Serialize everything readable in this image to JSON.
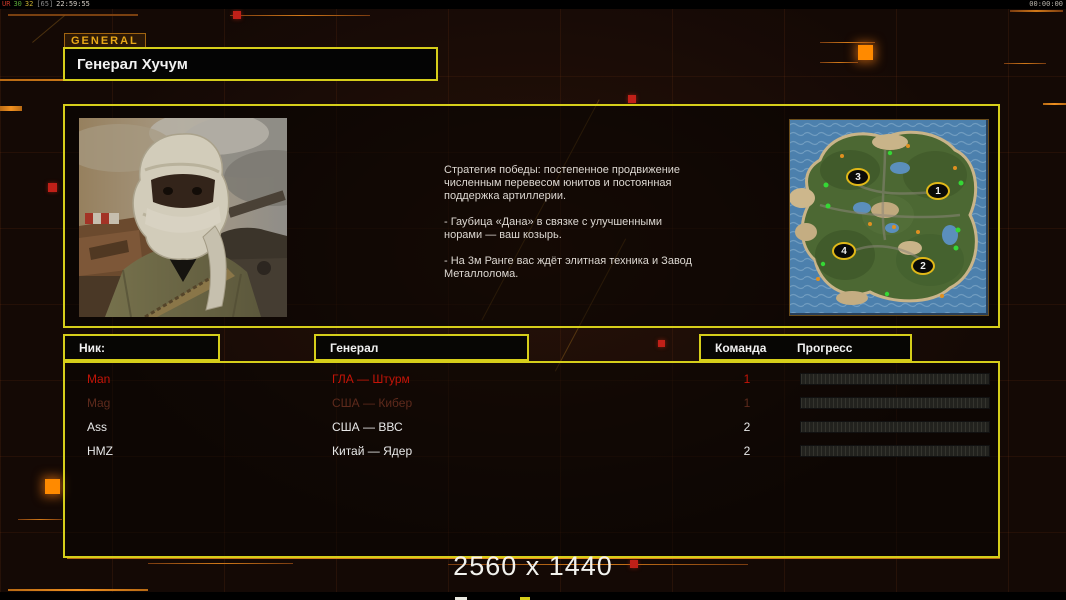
{
  "topbar": {
    "debug": {
      "p1": "UR",
      "p2": "30",
      "p3": "32",
      "p4": "[65]",
      "time": "22:59:55"
    },
    "timer": "00:00:00"
  },
  "header": {
    "tab_label": "GENERAL",
    "title": "Генерал Хучум"
  },
  "briefing": {
    "paragraphs": [
      "Стратегия победы: постепенное продвижение численным перевесом юнитов и постоянная поддержка артиллерии.",
      "- Гаубица «Дана» в связке с улучшенными норами — ваш козырь.",
      "- На 3м Ранге вас ждёт элитная техника и Завод Металлолома."
    ]
  },
  "minimap": {
    "markers": [
      {
        "label": "1"
      },
      {
        "label": "2"
      },
      {
        "label": "3"
      },
      {
        "label": "4"
      }
    ]
  },
  "table": {
    "headers": {
      "nick": "Ник:",
      "general": "Генерал",
      "team": "Команда",
      "progress": "Прогресс"
    },
    "rows": [
      {
        "nick": "Man",
        "general": "ГЛА — Штурм",
        "team": "1",
        "state": "red"
      },
      {
        "nick": "Mag",
        "general": "США — Кибер",
        "team": "1",
        "state": "dim"
      },
      {
        "nick": "Ass",
        "general": "США — ВВС",
        "team": "2",
        "state": "normal"
      },
      {
        "nick": "HMZ",
        "general": "Китай — Ядер",
        "team": "2",
        "state": "normal"
      }
    ]
  },
  "footer": {
    "resolution": "2560 x 1440"
  },
  "colors": {
    "accent_yellow": "#d6ce1a",
    "accent_orange": "#e08818",
    "alert_red": "#c41408"
  }
}
